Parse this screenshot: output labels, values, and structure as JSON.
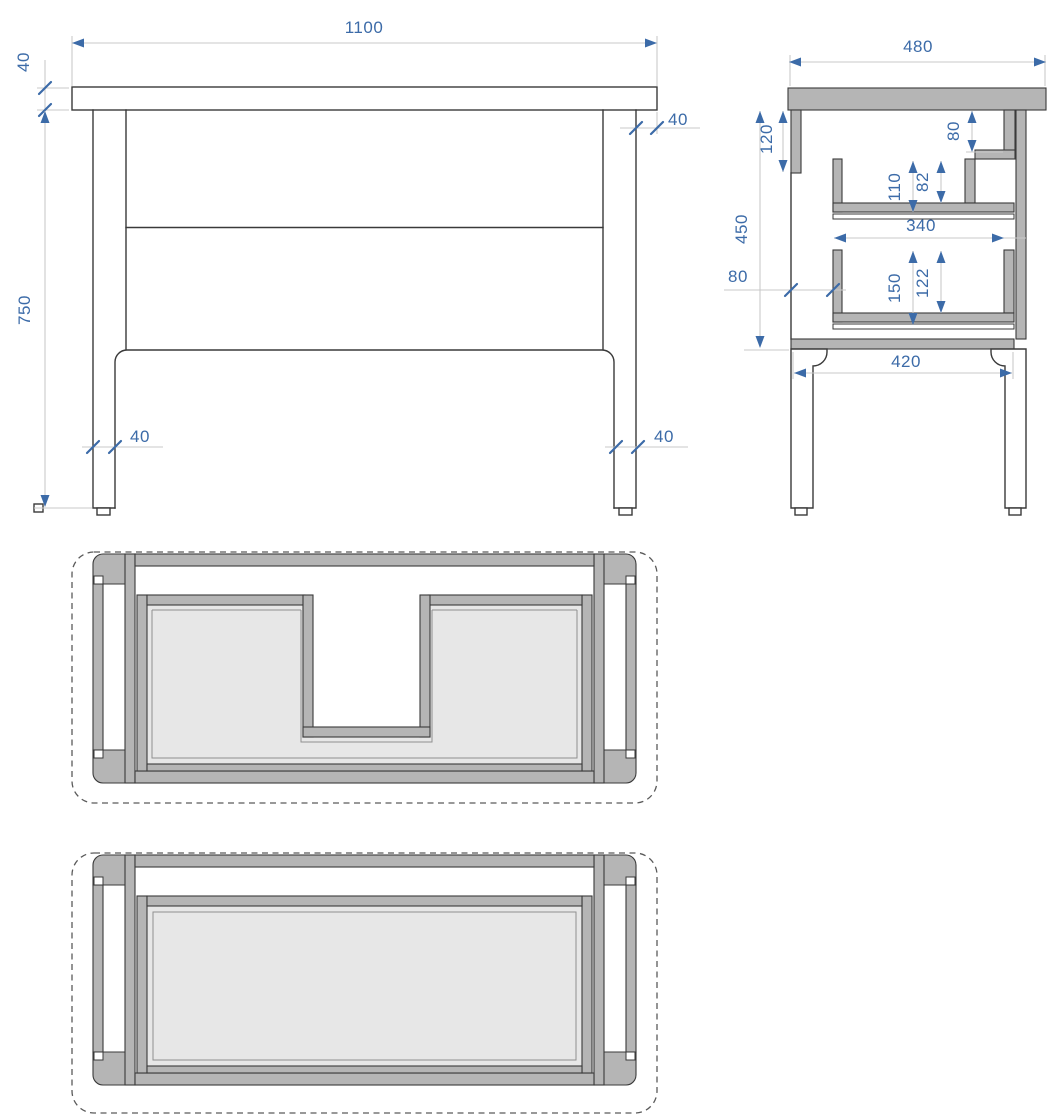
{
  "drawing": {
    "type": "furniture-technical-drawing",
    "views": [
      "front-elevation",
      "side-section",
      "plan-section-upper-drawer",
      "plan-section-lower-drawer"
    ],
    "colors": {
      "dimension": "#3c6ba8",
      "panel_gray": "#b5b5b5",
      "drawer_fill": "#e7e7e7",
      "outline": "#3a3a3a",
      "extension": "#c9c9c9"
    },
    "dims": {
      "front_width": "1100",
      "front_top_thickness": "40",
      "front_height": "750",
      "front_overhang": "40",
      "front_leg_left": "40",
      "front_leg_right": "40",
      "side_depth": "480",
      "side_back_rail": "120",
      "side_front_rail": "80",
      "side_drawer1_total": "110",
      "side_drawer1_inner": "82",
      "side_body_height": "450",
      "side_drawer_depth": "340",
      "side_back_gap": "80",
      "side_drawer2_total": "150",
      "side_drawer2_inner": "122",
      "side_leg_span": "420"
    }
  }
}
